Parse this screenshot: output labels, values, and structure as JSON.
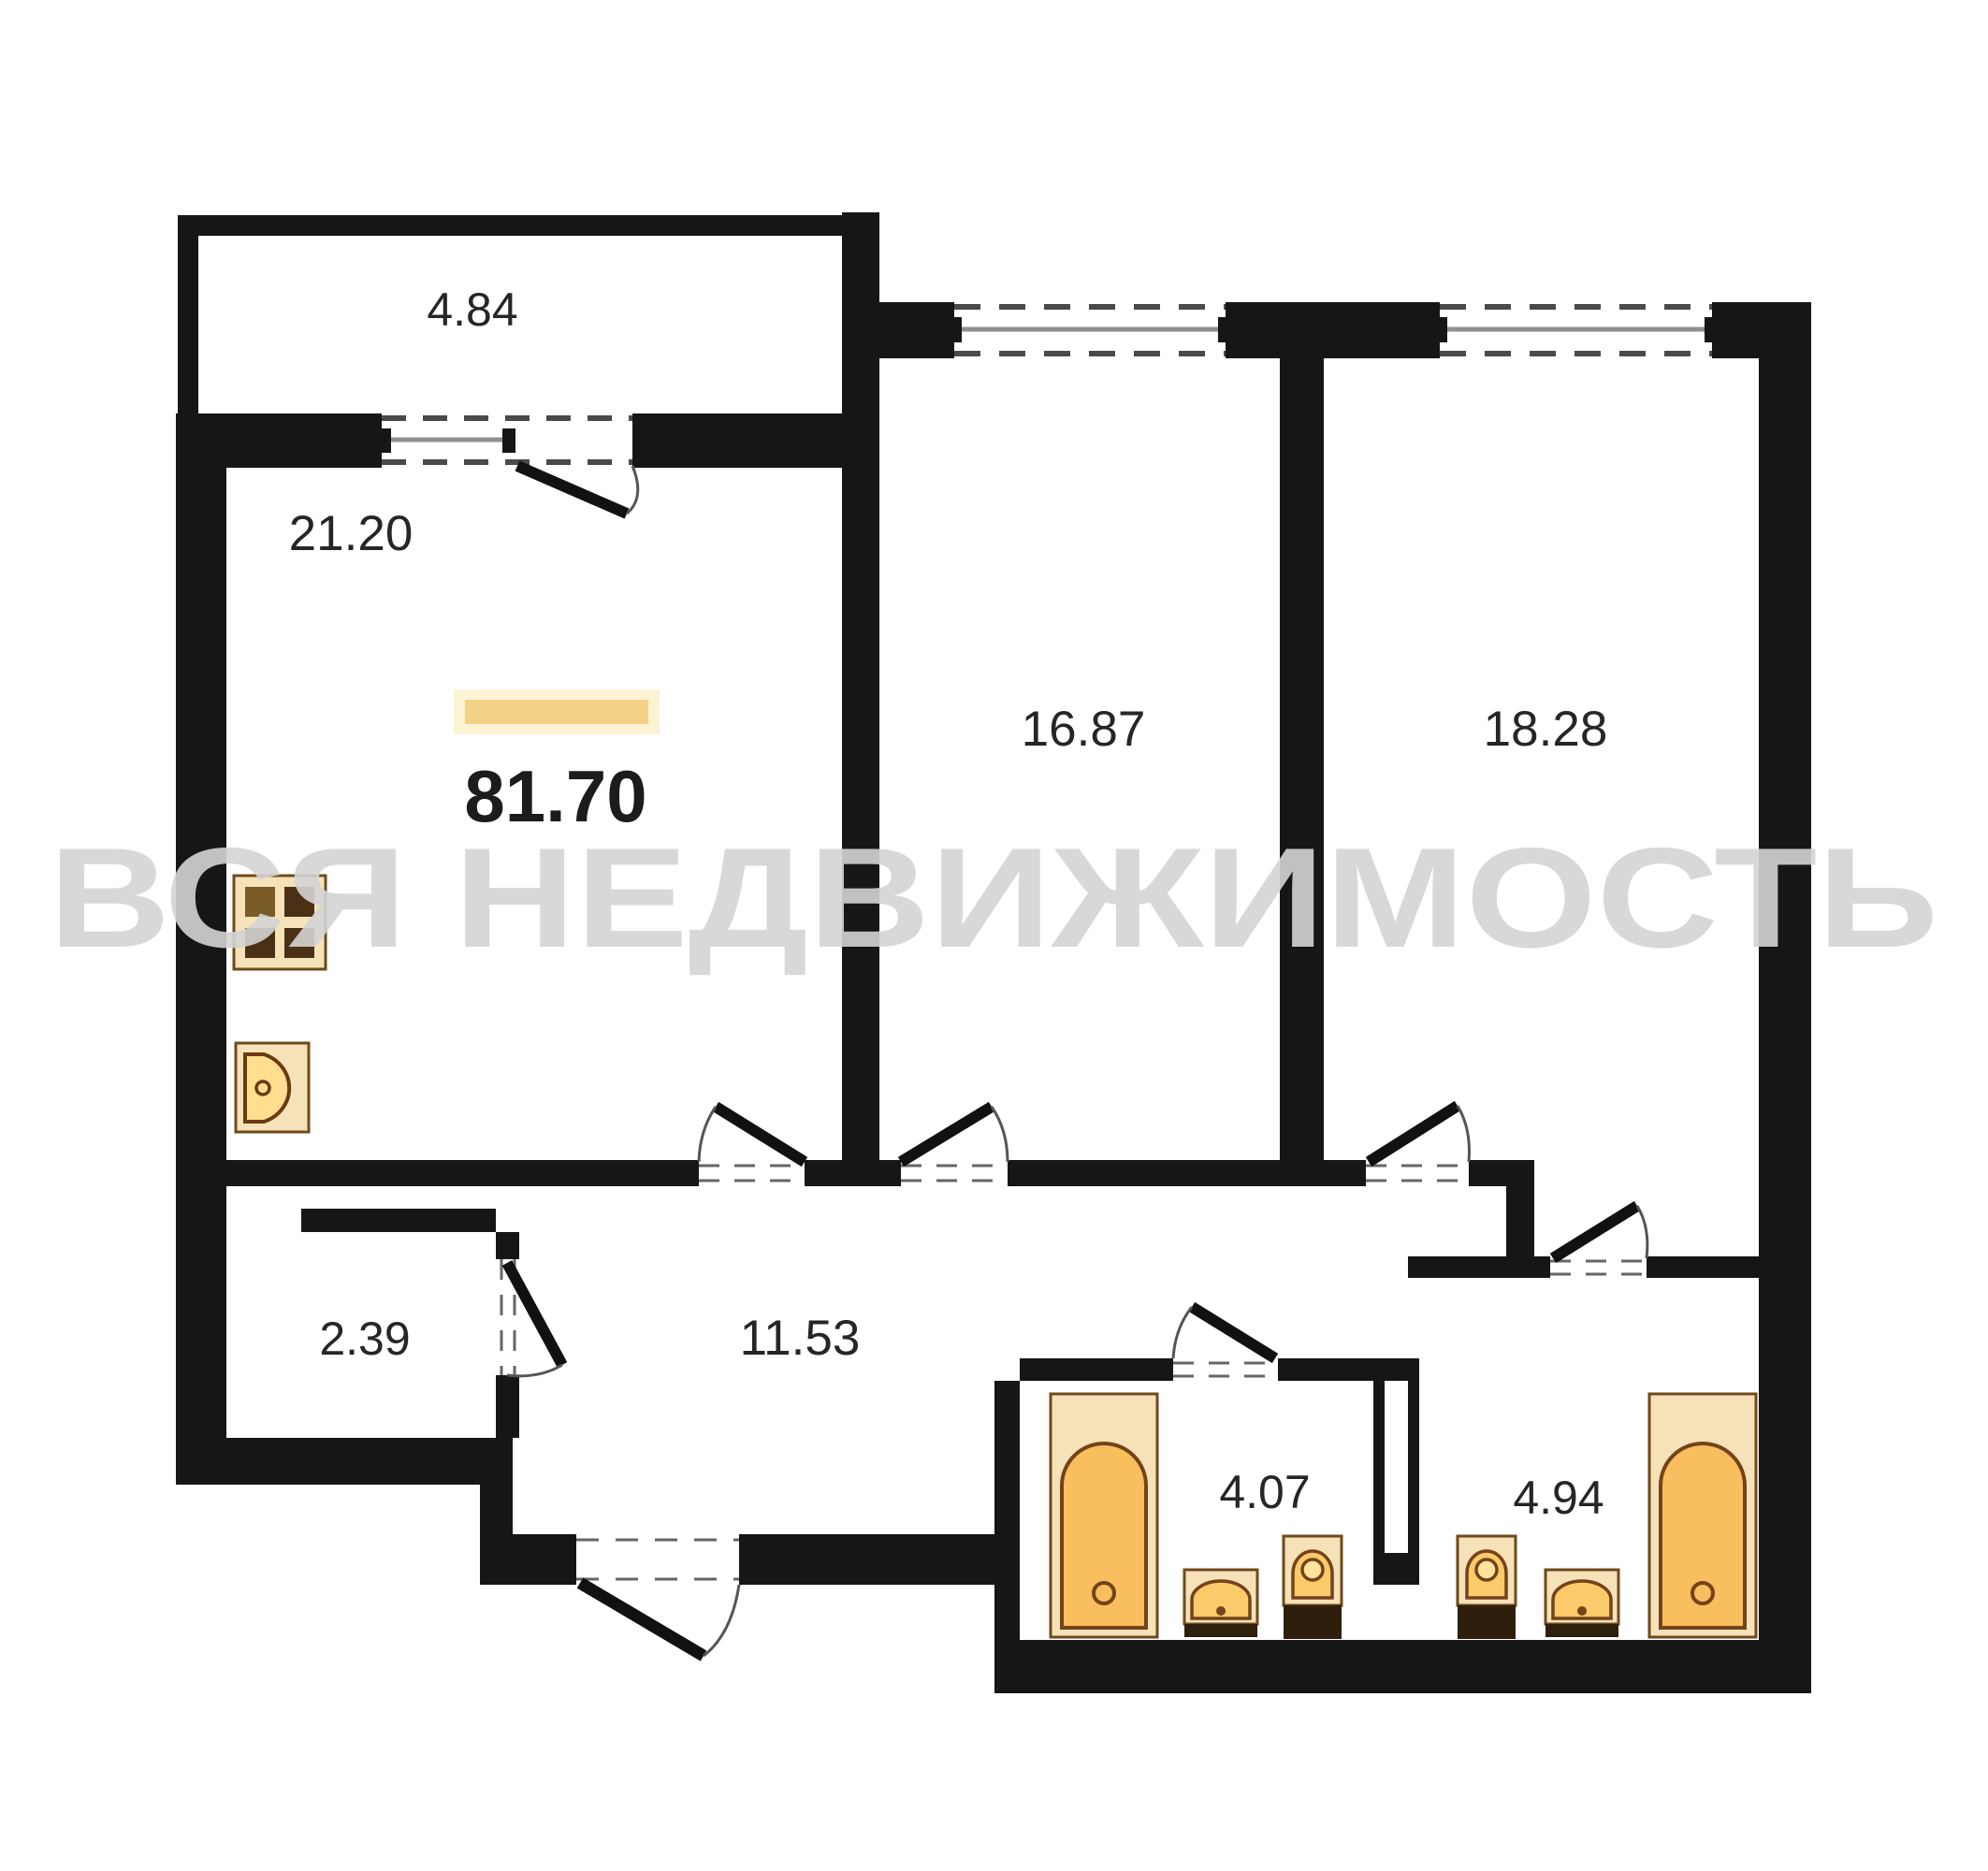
{
  "watermark": "ВСЯ НЕДВИЖИМОСТЬ",
  "total": {
    "area": "81.70"
  },
  "rooms": [
    {
      "id": "balcony",
      "area": "4.84"
    },
    {
      "id": "living-room-kitchen",
      "area": "21.20"
    },
    {
      "id": "bedroom-1",
      "area": "16.87"
    },
    {
      "id": "bedroom-2",
      "area": "18.28"
    },
    {
      "id": "wardrobe",
      "area": "2.39"
    },
    {
      "id": "hallway",
      "area": "11.53"
    },
    {
      "id": "bathroom-1",
      "area": "4.07"
    },
    {
      "id": "bathroom-2",
      "area": "4.94"
    }
  ],
  "colors": {
    "wall": "#161616",
    "window_line": "#8f8f8f",
    "fixture_fill": "#f6e2b8",
    "fixture_stroke": "#70491c",
    "fixture_accent": "#f9be5e",
    "fixture_base": "#2e1f0d",
    "total_bar": "#f3d288",
    "watermark": "#d4d4d4"
  },
  "icons": [
    "stove-icon",
    "kitchen-sink-icon",
    "bathtub-icon",
    "toilet-icon",
    "washbasin-icon",
    "door-swing-icon",
    "window-icon"
  ]
}
